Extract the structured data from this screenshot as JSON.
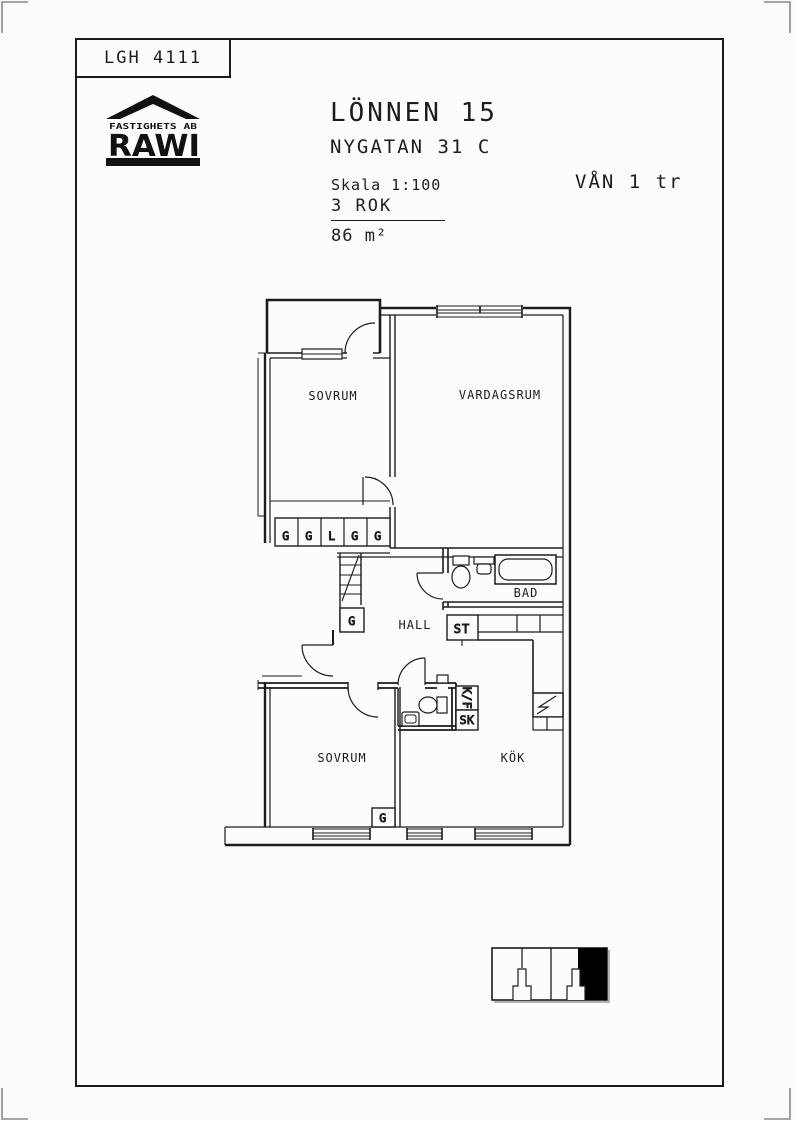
{
  "header": {
    "apartment_id": "LGH 4111",
    "logo": {
      "line1": "FASTIGHETS AB",
      "line2": "RAWI"
    },
    "property": "LÖNNEN 15",
    "address": "NYGATAN 31 C",
    "scale": "Skala 1:100",
    "rooms": "3 ROK",
    "area": "86 m²",
    "floor": "VÅN 1 tr"
  },
  "plan": {
    "rooms": [
      {
        "id": "sovrum-1",
        "label": "SOVRUM"
      },
      {
        "id": "vardagsrum",
        "label": "VARDAGSRUM"
      },
      {
        "id": "hall",
        "label": "HALL"
      },
      {
        "id": "bad",
        "label": "BAD"
      },
      {
        "id": "st",
        "label": "ST"
      },
      {
        "id": "sovrum-2",
        "label": "SOVRUM"
      },
      {
        "id": "kok",
        "label": "KÖK"
      }
    ],
    "wardrobes_row": [
      "G",
      "G",
      "L",
      "G",
      "G"
    ],
    "hall_wardrobe": "G",
    "sovrum2_wardrobe": "G",
    "kitchen_units": {
      "fridge_freezer": "K/F",
      "cupboard": "SK"
    },
    "line_color": "#1c1c1c"
  },
  "footprint": {
    "sections": 4,
    "highlighted": "rightmost apartment",
    "fill": "#000000"
  }
}
